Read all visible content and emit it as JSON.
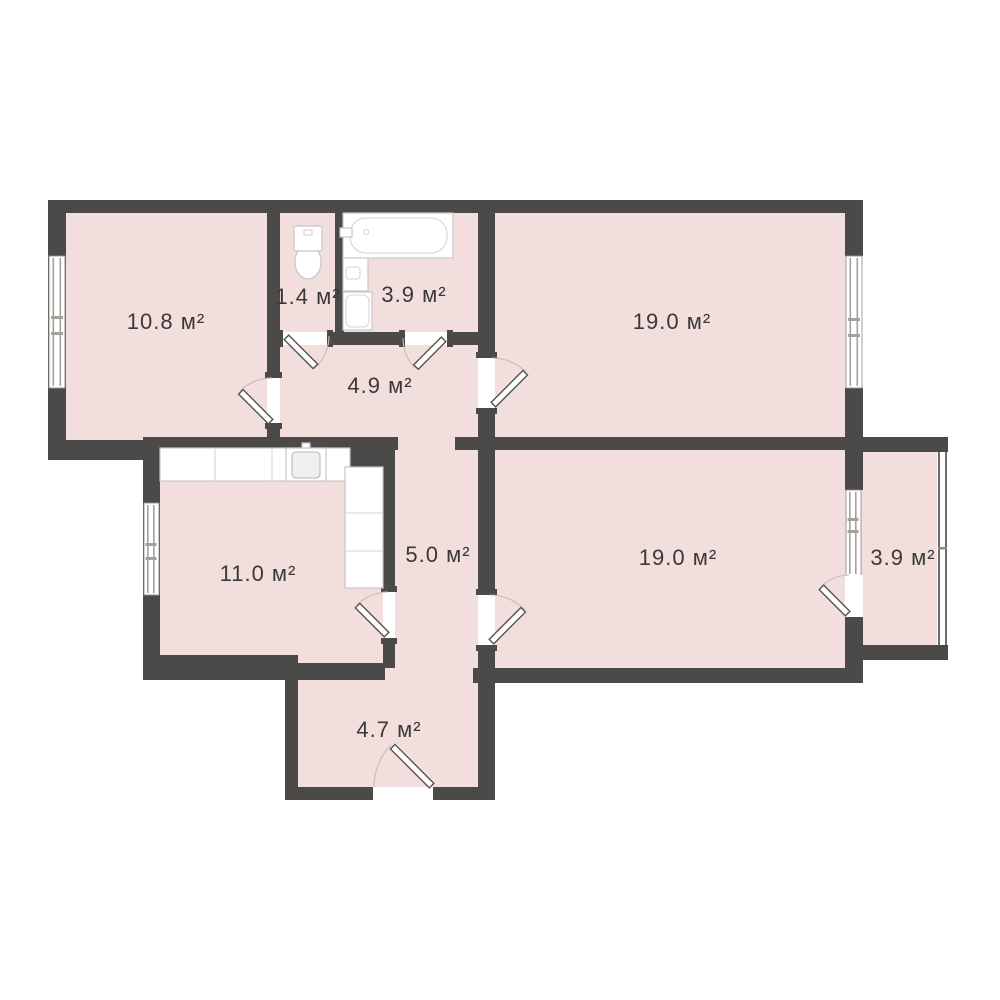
{
  "plan": {
    "name": "apartment-floor-plan",
    "area_unit": "м²",
    "rooms": [
      {
        "id": "room-top-left",
        "label": "10.8 м²"
      },
      {
        "id": "wc",
        "label": "1.4 м²"
      },
      {
        "id": "bathroom",
        "label": "3.9 м²"
      },
      {
        "id": "room-top-right",
        "label": "19.0 м²"
      },
      {
        "id": "hallway",
        "label": "4.9 м²"
      },
      {
        "id": "kitchen",
        "label": "11.0 м²"
      },
      {
        "id": "corridor",
        "label": "5.0 м²"
      },
      {
        "id": "room-bottom-right",
        "label": "19.0 м²"
      },
      {
        "id": "balcony",
        "label": "3.9 м²"
      },
      {
        "id": "entrance-hall",
        "label": "4.7 м²"
      }
    ],
    "colors": {
      "wall": "#4b4a48",
      "floor": "#f2dedc",
      "background": "#ffffff",
      "label_text": "#3a3935"
    }
  }
}
